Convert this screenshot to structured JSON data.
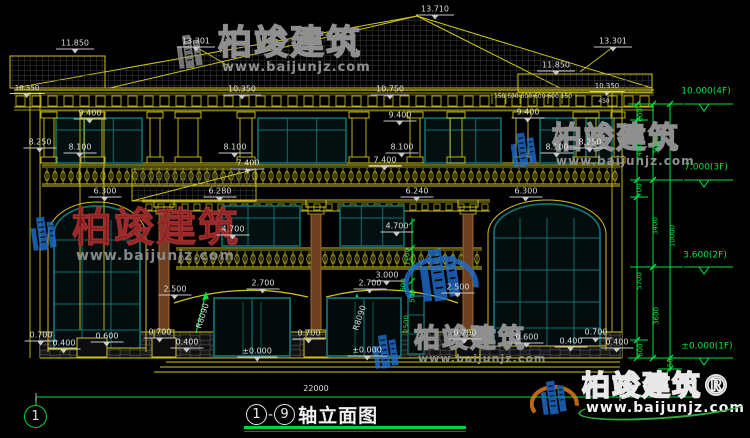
{
  "title": {
    "axis_from": "1",
    "dash": "-",
    "axis_to": "9",
    "suffix": "轴立面图",
    "full_text": "1-9轴立面图"
  },
  "axis_bubble": {
    "label": "1"
  },
  "colors": {
    "background": "#000000",
    "linework": "#cfc41b",
    "dimension_green": "#00e53e",
    "window_frame": "#0f6f6f",
    "column_wood": "#6e3f20",
    "text": "#dedede",
    "title_underline": "#00d435",
    "watermark_red": "#701616",
    "watermark_blue": "#1e6fd0",
    "watermark_orange": "#e8821e"
  },
  "floor_elevations": [
    {
      "label": "10.000(4F)"
    },
    {
      "label": "7.000(3F)"
    },
    {
      "label": "3.600(2F)"
    },
    {
      "label": "±0.000(1F)"
    }
  ],
  "overall_width_mm": "22000",
  "overall_height_mm": "10000",
  "watermarks": [
    {
      "style": "gray",
      "text": "柏竣建筑",
      "url": "www.baijunjz.com",
      "x": 166,
      "y": 26,
      "size": 34,
      "urlsize": 13,
      "logo": "gray"
    },
    {
      "style": "gray",
      "text": "柏竣建筑",
      "url": "www.baijunjz.com",
      "x": 500,
      "y": 124,
      "size": 30,
      "urlsize": 12,
      "logo": "blue"
    },
    {
      "style": "red",
      "text": "柏竣建筑",
      "url": "www.baijunjz.com",
      "x": 20,
      "y": 208,
      "size": 40,
      "urlsize": 14,
      "logo": "blue"
    },
    {
      "style": "logo-only",
      "text": "",
      "url": "",
      "x": 403,
      "y": 236,
      "size": 0,
      "urlsize": 0,
      "logo": "blue-big"
    },
    {
      "style": "gray",
      "text": "柏竣建筑",
      "url": "www.baijunjz.com",
      "x": 362,
      "y": 326,
      "size": 26,
      "urlsize": 11,
      "logo": "blue"
    },
    {
      "style": "bright",
      "text": "柏竣建筑®",
      "url": "www.baijunjz.com",
      "x": 530,
      "y": 372,
      "size": 28,
      "urlsize": 14,
      "logo": "color"
    }
  ],
  "annotations": [
    {
      "text": "13.710",
      "x": 435,
      "y": 10,
      "cls": "w"
    },
    {
      "text": "13.301",
      "x": 196,
      "y": 42,
      "cls": "w"
    },
    {
      "text": "13.301",
      "x": 613,
      "y": 42,
      "cls": "w"
    },
    {
      "text": "11.850",
      "x": 75,
      "y": 44,
      "cls": "w"
    },
    {
      "text": "11.850",
      "x": 556,
      "y": 66,
      "cls": "w"
    },
    {
      "text": "10.350",
      "x": 27,
      "y": 89,
      "cls": "w",
      "size": 7
    },
    {
      "text": "10.350",
      "x": 242,
      "y": 90,
      "cls": "w"
    },
    {
      "text": "10.750",
      "x": 390,
      "y": 90,
      "cls": "w"
    },
    {
      "text": "10.350",
      "x": 607,
      "y": 87,
      "cls": "w",
      "size": 7
    },
    {
      "text": "150 600 600 600 600 150",
      "x": 533,
      "y": 97,
      "cls": "wp",
      "size": 6
    },
    {
      "text": "450",
      "x": 604,
      "y": 102,
      "cls": "wp",
      "size": 6
    },
    {
      "text": "9.400",
      "x": 90,
      "y": 114,
      "cls": "w"
    },
    {
      "text": "9.400",
      "x": 400,
      "y": 116,
      "cls": "w"
    },
    {
      "text": "9.400",
      "x": 528,
      "y": 113,
      "cls": "w"
    },
    {
      "text": "8.250",
      "x": 40,
      "y": 143,
      "cls": "w"
    },
    {
      "text": "8.250",
      "x": 590,
      "y": 143,
      "cls": "w"
    },
    {
      "text": "8.100",
      "x": 80,
      "y": 148,
      "cls": "w"
    },
    {
      "text": "8.100",
      "x": 235,
      "y": 148,
      "cls": "w"
    },
    {
      "text": "8.100",
      "x": 402,
      "y": 148,
      "cls": "w"
    },
    {
      "text": "8.100",
      "x": 557,
      "y": 148,
      "cls": "w"
    },
    {
      "text": "7.400",
      "x": 248,
      "y": 164,
      "cls": "w"
    },
    {
      "text": "7.400",
      "x": 385,
      "y": 161,
      "cls": "w"
    },
    {
      "text": "6.300",
      "x": 105,
      "y": 192,
      "cls": "w"
    },
    {
      "text": "6.280",
      "x": 220,
      "y": 192,
      "cls": "w"
    },
    {
      "text": "6.240",
      "x": 417,
      "y": 192,
      "cls": "w"
    },
    {
      "text": "6.300",
      "x": 526,
      "y": 192,
      "cls": "w"
    },
    {
      "text": "4.700",
      "x": 233,
      "y": 230,
      "cls": "w"
    },
    {
      "text": "4.700",
      "x": 397,
      "y": 227,
      "cls": "w"
    },
    {
      "text": "3.000",
      "x": 387,
      "y": 276,
      "cls": "w"
    },
    {
      "text": "2.700",
      "x": 263,
      "y": 284,
      "cls": "w"
    },
    {
      "text": "2.700",
      "x": 370,
      "y": 284,
      "cls": "w"
    },
    {
      "text": "2.500",
      "x": 175,
      "y": 290,
      "cls": "w"
    },
    {
      "text": "2.500",
      "x": 458,
      "y": 288,
      "cls": "w"
    },
    {
      "text": "R8090",
      "x": 203,
      "y": 316,
      "cls": "wp",
      "rot": -72
    },
    {
      "text": "R8090",
      "x": 360,
      "y": 318,
      "cls": "wp",
      "rot": -72
    },
    {
      "text": "0.700",
      "x": 41,
      "y": 336,
      "cls": "w"
    },
    {
      "text": "0.400",
      "x": 64,
      "y": 344,
      "cls": "w"
    },
    {
      "text": "0.600",
      "x": 107,
      "y": 337,
      "cls": "w"
    },
    {
      "text": "0.700",
      "x": 160,
      "y": 333,
      "cls": "w"
    },
    {
      "text": "0.400",
      "x": 187,
      "y": 343,
      "cls": "w"
    },
    {
      "text": "0.700",
      "x": 309,
      "y": 334,
      "cls": "w"
    },
    {
      "text": "0.700",
      "x": 465,
      "y": 334,
      "cls": "w"
    },
    {
      "text": "0.600",
      "x": 527,
      "y": 338,
      "cls": "w"
    },
    {
      "text": "0.400",
      "x": 571,
      "y": 342,
      "cls": "w"
    },
    {
      "text": "0.700",
      "x": 596,
      "y": 333,
      "cls": "w"
    },
    {
      "text": "0.400",
      "x": 617,
      "y": 343,
      "cls": "w"
    },
    {
      "text": "±0.000",
      "x": 257,
      "y": 352,
      "cls": "w"
    },
    {
      "text": "±0.000",
      "x": 367,
      "y": 351,
      "cls": "w"
    },
    {
      "text": "22000",
      "x": 316,
      "y": 389,
      "cls": "wp"
    },
    {
      "text": "600",
      "x": 641,
      "y": 115,
      "cls": "g",
      "rot": -90
    },
    {
      "text": "2400",
      "x": 640,
      "y": 152,
      "cls": "g",
      "rot": -90
    },
    {
      "text": "3000",
      "x": 657,
      "y": 145,
      "cls": "g",
      "rot": -90
    },
    {
      "text": "700",
      "x": 640,
      "y": 190,
      "cls": "g",
      "rot": -90
    },
    {
      "text": "3400",
      "x": 656,
      "y": 226,
      "cls": "g",
      "rot": -90
    },
    {
      "text": "10000",
      "x": 673,
      "y": 236,
      "cls": "g",
      "rot": -90
    },
    {
      "text": "5700",
      "x": 640,
      "y": 281,
      "cls": "g",
      "rot": -90
    },
    {
      "text": "3600",
      "x": 657,
      "y": 316,
      "cls": "g",
      "rot": -90
    },
    {
      "text": "600",
      "x": 641,
      "y": 350,
      "cls": "g",
      "rot": -90
    },
    {
      "text": "450",
      "x": 671,
      "y": 365,
      "cls": "g",
      "rot": -90
    },
    {
      "text": "1100",
      "x": 408,
      "y": 257,
      "cls": "g",
      "rot": -90
    },
    {
      "text": "600",
      "x": 404,
      "y": 285,
      "cls": "g",
      "rot": -90
    },
    {
      "text": "500",
      "x": 413,
      "y": 296,
      "cls": "g",
      "rot": -90
    },
    {
      "text": "2500",
      "x": 407,
      "y": 324,
      "cls": "g",
      "rot": -90
    },
    {
      "text": "10.000(4F)",
      "x": 706,
      "y": 92,
      "cls": "ge"
    },
    {
      "text": "7.000(3F)",
      "x": 706,
      "y": 168,
      "cls": "ge"
    },
    {
      "text": "3.600(2F)",
      "x": 705,
      "y": 256,
      "cls": "ge"
    },
    {
      "text": "±0.000(1F)",
      "x": 707,
      "y": 347,
      "cls": "ge"
    }
  ]
}
